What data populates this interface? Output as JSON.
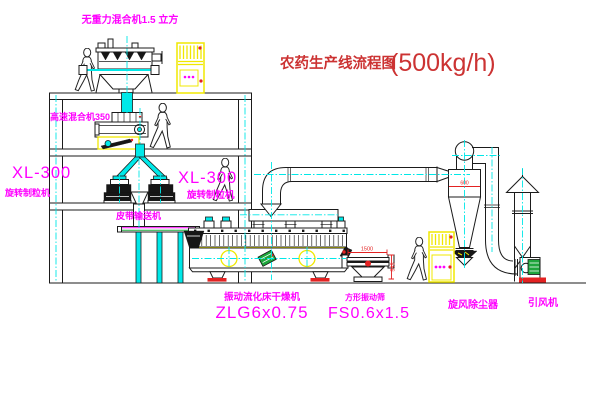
{
  "title": {
    "text": "农药生产线流程图",
    "capacity": "(500kg/h)"
  },
  "labels": {
    "gravity_mixer": "无重力混合机1.5 立方",
    "high_speed_mixer": "高速混合机350",
    "granulator_left": {
      "model": "XL-300",
      "name": "旋转制粒机"
    },
    "granulator_right": {
      "model": "XL-300",
      "name": "旋转制粒机"
    },
    "belt_conveyor": "皮带输送机",
    "fluid_bed_dryer": {
      "name": "振动流化床干燥机",
      "model": "ZLG6x0.75"
    },
    "vibrating_sieve": {
      "name": "方形振动筛",
      "model": "FS0.6x1.5"
    },
    "cyclone": "旋风除尘器",
    "induced_draft_fan": "引风机"
  },
  "dimensions": {
    "cyclone_inlet": "600",
    "sieve_length": "1500",
    "sieve_height": "545"
  },
  "colors": {
    "label": "#ff00ff",
    "title_color": "#cc3333",
    "centerline": "#00e8e8",
    "highlight": "#f0e800",
    "motor": "#1fa53c",
    "accent_red": "#e32222"
  }
}
